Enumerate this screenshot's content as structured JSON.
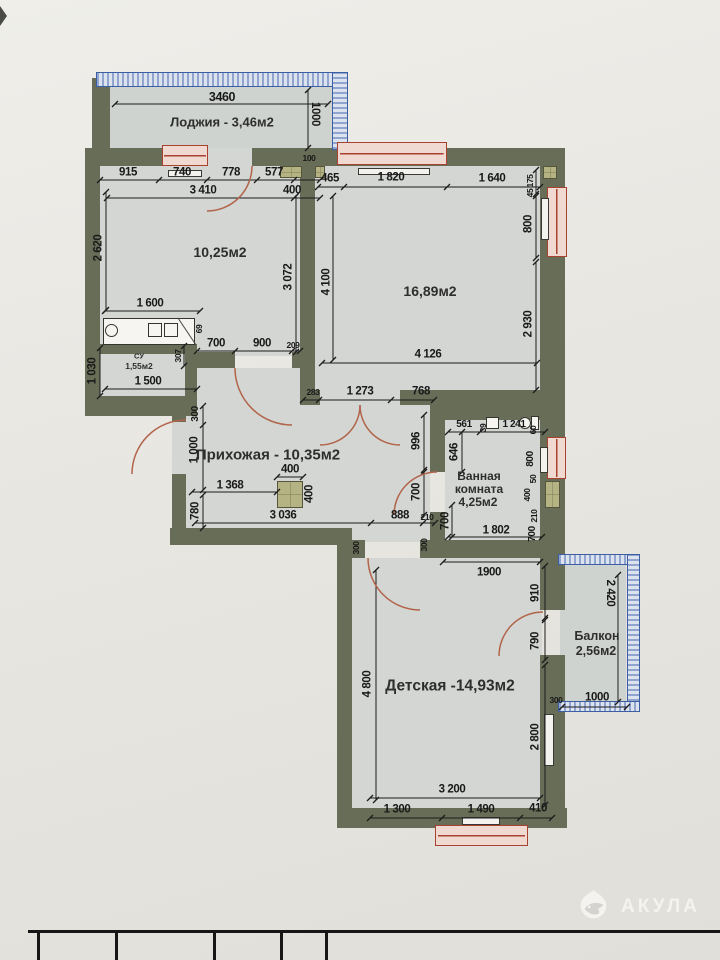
{
  "brand": {
    "name": "АКУЛА"
  },
  "rooms": {
    "loggia": {
      "label": "Лоджия - 3,46м2"
    },
    "room1": {
      "label": "10,25м2"
    },
    "room2": {
      "label": "16,89м2"
    },
    "su": {
      "name": "СУ",
      "area": "1,55м2"
    },
    "hall": {
      "label": "Прихожая - 10,35м2"
    },
    "bath": {
      "l1": "Ванная",
      "l2": "комната",
      "l3": "4,25м2"
    },
    "kids": {
      "label": "Детская -14,93м2"
    },
    "balcony": {
      "l1": "Балкон",
      "l2": "2,56м2"
    }
  },
  "dims": {
    "loggia_w": "3460",
    "loggia_h": "1000",
    "t915": "915",
    "t740": "740",
    "t778": "778",
    "t577": "577",
    "t400": "400",
    "t100": "100",
    "t3410": "3 410",
    "r2_465": "465",
    "r2_1820": "1 820",
    "r2_1640": "1 640",
    "r2_4126": "4 126",
    "r2_4100": "4 100",
    "r2_175": "175",
    "r2_45": "45",
    "r2_800": "800",
    "r2_2930": "2 930",
    "r1_2620": "2 620",
    "r1_3072": "3 072",
    "r1_1600": "1 600",
    "r1_700": "700",
    "r1_900": "900",
    "r1_209": "209",
    "r1_69": "69",
    "r1_307": "307",
    "su_1030": "1 030",
    "su_1500": "1 500",
    "ent_300": "300",
    "ent_1000": "1 000",
    "ent_780": "780",
    "h_1368": "1 368",
    "h_400t": "400",
    "h_400r": "400",
    "h_3036": "3 036",
    "h_888": "888",
    "h_210": "210",
    "h_283": "283",
    "h_1273": "1 273",
    "h_768": "768",
    "h_996": "996",
    "h_700": "700",
    "h_300a": "300",
    "h_300b": "300",
    "b_561": "561",
    "b_39": "39",
    "b_1241": "1 241",
    "b_646": "646",
    "b_700l": "700",
    "b_1802": "1 802",
    "b_60": "60",
    "b_800": "800",
    "b_50": "50",
    "b_400": "400",
    "b_210": "210",
    "b_700r": "700",
    "k_1900": "1900",
    "k_910": "910",
    "k_790": "790",
    "k_4800": "4 800",
    "k_2800": "2 800",
    "k_3200": "3 200",
    "k_1300": "1 300",
    "k_1490": "1 490",
    "k_410": "410",
    "bl_2420": "2 420",
    "bl_1000": "1000",
    "bl_300": "300"
  }
}
